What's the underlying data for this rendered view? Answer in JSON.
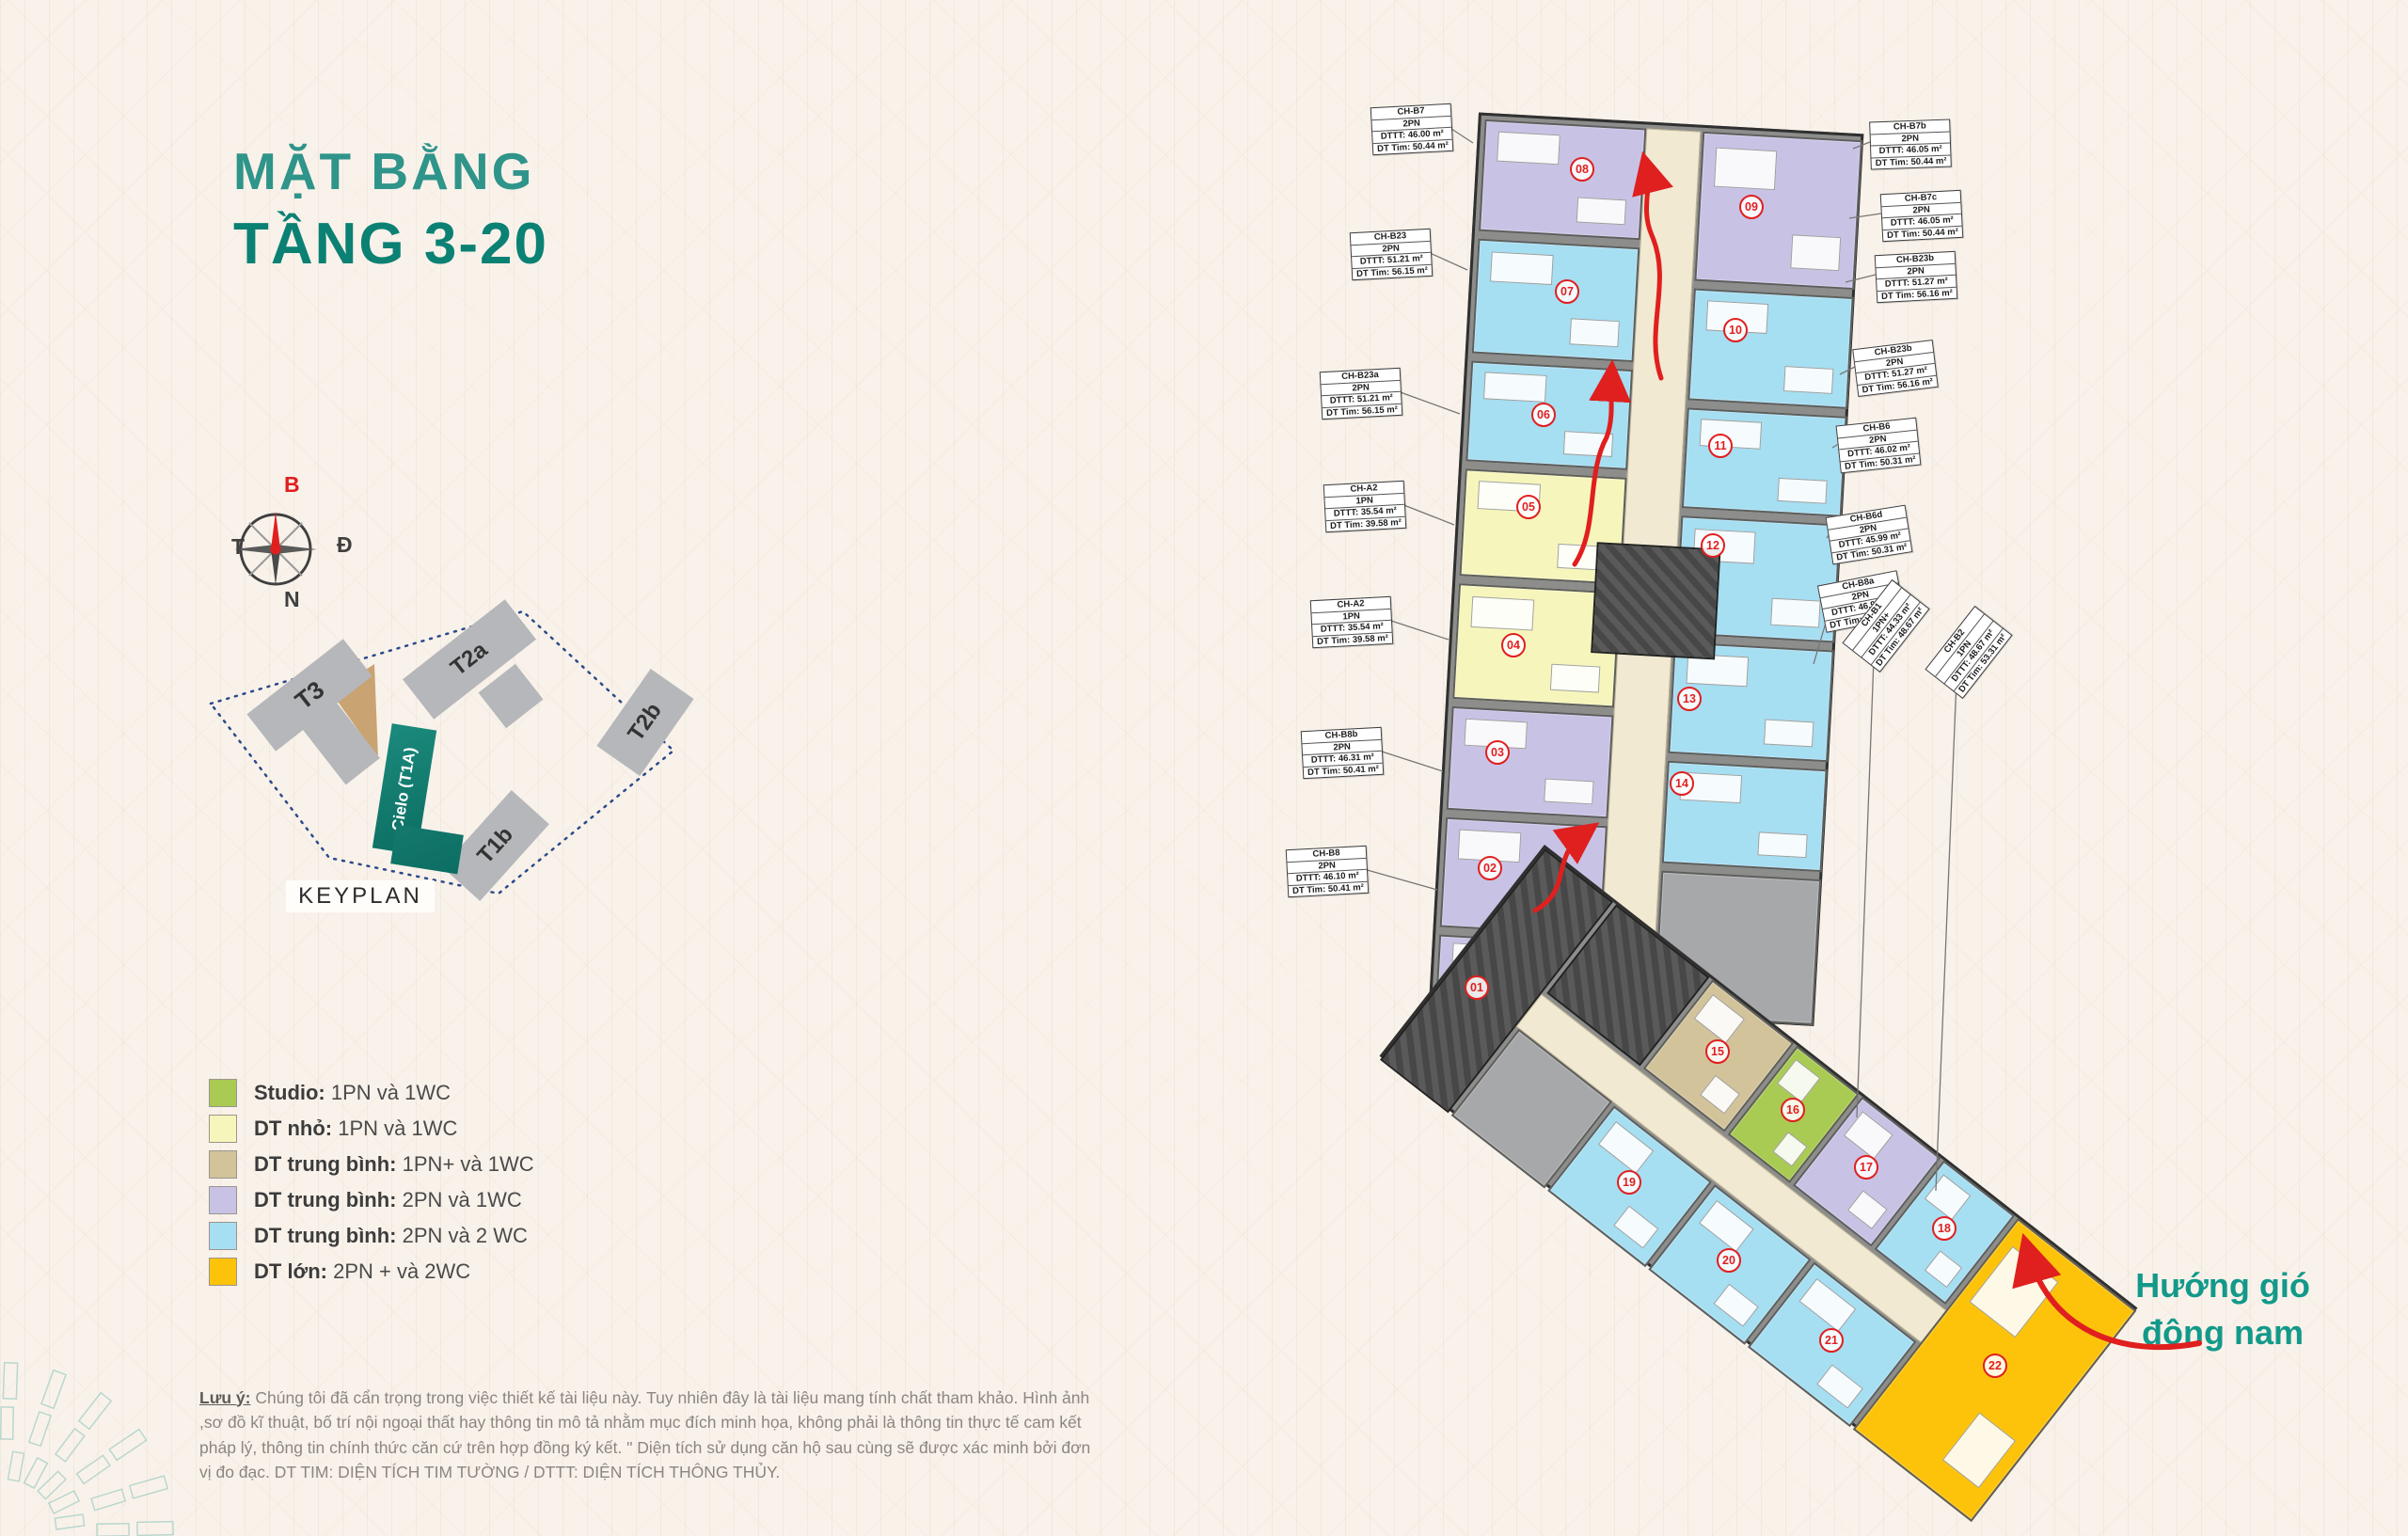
{
  "page": {
    "title_line1": "MẶT BẰNG",
    "title_line2": "TẦNG 3-20",
    "keyplan_label": "KEYPLAN",
    "wind_line1": "Hướng gió",
    "wind_line2": "đông nam"
  },
  "compass": {
    "north": "B",
    "west": "T",
    "east": "Đ",
    "south": "N"
  },
  "keyplan": {
    "towers": [
      {
        "name": "T3"
      },
      {
        "name": "T2a"
      },
      {
        "name": "T2b"
      },
      {
        "name": "T1b"
      },
      {
        "name": "Cielo (T1A)",
        "highlighted": true
      }
    ]
  },
  "legend": {
    "items": [
      {
        "label": "Studio:",
        "desc": "1PN và 1WC",
        "color": "#a9cb53"
      },
      {
        "label": "DT nhỏ:",
        "desc": "1PN  và 1WC",
        "color": "#f6f6bc"
      },
      {
        "label": "DT trung bình:",
        "desc": "1PN+ và 1WC",
        "color": "#d2c39b"
      },
      {
        "label": "DT trung bình:",
        "desc": "2PN và 1WC",
        "color": "#c8c3e5"
      },
      {
        "label": "DT trung bình:",
        "desc": "2PN và 2 WC",
        "color": "#a6def2"
      },
      {
        "label": "DT lớn:",
        "desc": "2PN + và 2WC",
        "color": "#fdc30b"
      }
    ]
  },
  "plan": {
    "units": [
      {
        "number": "08",
        "type": "2PN và 1WC"
      },
      {
        "number": "07",
        "type": "2PN và 2WC"
      },
      {
        "number": "06",
        "type": "2PN và 2WC"
      },
      {
        "number": "05",
        "type": "1PN và 1WC"
      },
      {
        "number": "04",
        "type": "1PN và 1WC"
      },
      {
        "number": "03",
        "type": "2PN và 1WC"
      },
      {
        "number": "02",
        "type": "2PN và 1WC"
      },
      {
        "number": "01",
        "type": "2PN và 1WC"
      },
      {
        "number": "09",
        "type": "2PN và 1WC"
      },
      {
        "number": "10",
        "type": "2PN và 2WC"
      },
      {
        "number": "11",
        "type": "2PN và 2WC"
      },
      {
        "number": "12",
        "type": "2PN và 2WC"
      },
      {
        "number": "13",
        "type": "2PN và 2WC"
      },
      {
        "number": "14",
        "type": "2PN và 2WC"
      },
      {
        "number": "15",
        "type": "1PN+ và 1WC"
      },
      {
        "number": "16",
        "type": "Studio"
      },
      {
        "number": "17",
        "type": "2PN và 1WC"
      },
      {
        "number": "18",
        "type": "2PN và 2WC"
      },
      {
        "number": "19",
        "type": "2PN và 2WC"
      },
      {
        "number": "20",
        "type": "2PN và 2WC"
      },
      {
        "number": "21",
        "type": "2PN và 2WC"
      },
      {
        "number": "22",
        "type": "2PN + và 2WC"
      }
    ],
    "callouts": {
      "left": [
        {
          "code": "CH-B7",
          "bed": "2PN",
          "dttt": "DTTT: 46.00 m²",
          "dttim": "DT Tim: 50.44 m²"
        },
        {
          "code": "CH-B23",
          "bed": "2PN",
          "dttt": "DTTT: 51.21 m²",
          "dttim": "DT Tim: 56.15 m²"
        },
        {
          "code": "CH-B23a",
          "bed": "2PN",
          "dttt": "DTTT: 51.21 m²",
          "dttim": "DT Tim: 56.15 m²"
        },
        {
          "code": "CH-A2",
          "bed": "1PN",
          "dttt": "DTTT: 35.54 m²",
          "dttim": "DT Tim: 39.58 m²"
        },
        {
          "code": "CH-A2",
          "bed": "1PN",
          "dttt": "DTTT: 35.54 m²",
          "dttim": "DT Tim: 39.58 m²"
        },
        {
          "code": "CH-B8b",
          "bed": "2PN",
          "dttt": "DTTT: 46.31 m²",
          "dttim": "DT Tim: 50.41 m²"
        },
        {
          "code": "CH-B8",
          "bed": "2PN",
          "dttt": "DTTT: 46.10 m²",
          "dttim": "DT Tim: 50.41 m²"
        }
      ],
      "right": [
        {
          "code": "CH-B7b",
          "bed": "2PN",
          "dttt": "DTTT: 46.05 m²",
          "dttim": "DT Tim: 50.44 m²"
        },
        {
          "code": "CH-B7c",
          "bed": "2PN",
          "dttt": "DTTT: 46.05 m²",
          "dttim": "DT Tim: 50.44 m²"
        },
        {
          "code": "CH-B23b",
          "bed": "2PN",
          "dttt": "DTTT: 51.27 m²",
          "dttim": "DT Tim: 56.16 m²"
        },
        {
          "code": "CH-B23b",
          "bed": "2PN",
          "dttt": "DTTT: 51.27 m²",
          "dttim": "DT Tim: 56.16 m²"
        },
        {
          "code": "CH-B6",
          "bed": "2PN",
          "dttt": "DTTT: 46.02 m²",
          "dttim": "DT Tim: 50.31 m²"
        },
        {
          "code": "CH-B6d",
          "bed": "2PN",
          "dttt": "DTTT: 45.99 m²",
          "dttim": "DT Tim: 50.31 m²"
        },
        {
          "code": "CH-B8a",
          "bed": "2PN",
          "dttt": "DTTT: 46.92 m²",
          "dttim": "DT Tim: 51.01 m²"
        }
      ],
      "diag": [
        {
          "code": "CH-B1",
          "bed": "1PN+",
          "dttt": "DTTT: 44.33 m²",
          "dttim": "DT Tim: 48.67 m²"
        },
        {
          "code": "CH-B2",
          "bed": "1PN",
          "dttt": "DTTT: 48.67 m²",
          "dttim": "DT Tim: 53.31 m²"
        }
      ]
    }
  },
  "disclaimer": {
    "label": "Lưu ý:",
    "text": "Chúng tôi đã cẩn trọng trong việc thiết kế tài liệu này. Tuy nhiên đây là tài liệu mang tính chất tham khảo. Hình ảnh ,sơ đồ kĩ thuật, bố trí nội ngoại thất hay thông tin mô tả nhằm mục đích minh họa, không phải là thông tin thực tế cam kết pháp lý, thông tin chính thức căn cứ trên hợp đồng ký kết. \" Diện tích sử dụng căn hộ sau cùng  sẽ được xác minh bởi đơn vị đo đạc. DT TIM: DIỆN TÍCH TIM TƯỜNG /  DTTT: DIỆN TÍCH THÔNG THỦY."
  },
  "colors": {
    "accent_teal": "#0B8174",
    "title_teal": "#2F948A",
    "wind_red": "#E01F1F",
    "corridor": "#F1E9D2",
    "keyplan_dash": "#2B4A8B",
    "tower_gray": "#B5B7BA",
    "tower_tan": "#C9A372",
    "tower_teal": "#14796E"
  }
}
